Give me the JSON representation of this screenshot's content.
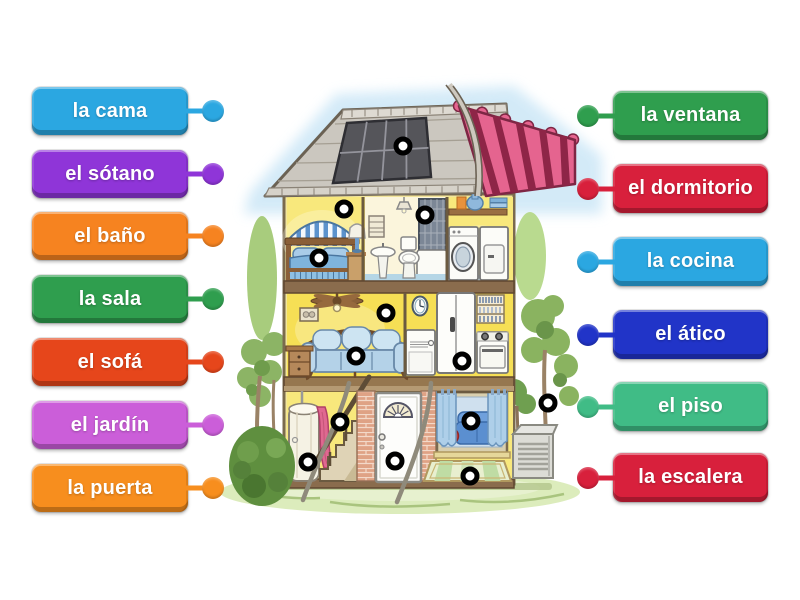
{
  "activity": {
    "type": "labelled-diagram",
    "background": "#ffffff",
    "marker_style": {
      "ring": "#000000",
      "center": "#ffffff"
    },
    "left_labels": [
      {
        "text": "la cama",
        "color": "#2BA7E1"
      },
      {
        "text": "el sótano",
        "color": "#8F35D8"
      },
      {
        "text": "el baño",
        "color": "#F68320"
      },
      {
        "text": "la sala",
        "color": "#2F9E4E"
      },
      {
        "text": "el sofá",
        "color": "#E6461B"
      },
      {
        "text": "el jardín",
        "color": "#CB5ED9"
      },
      {
        "text": "la puerta",
        "color": "#F78E1E"
      }
    ],
    "right_labels": [
      {
        "text": "la ventana",
        "color": "#2F9E4E"
      },
      {
        "text": "el dormitorio",
        "color": "#D8203C"
      },
      {
        "text": "la cocina",
        "color": "#2BA7E1"
      },
      {
        "text": "el ático",
        "color": "#2134C8"
      },
      {
        "text": "el piso",
        "color": "#40BC86"
      },
      {
        "text": "la escalera",
        "color": "#D8203C"
      }
    ],
    "markers": [
      {
        "name": "attic-roof",
        "x": 403,
        "y": 146
      },
      {
        "name": "bedroom",
        "x": 344,
        "y": 209
      },
      {
        "name": "bathroom",
        "x": 425,
        "y": 215
      },
      {
        "name": "bed",
        "x": 319,
        "y": 258
      },
      {
        "name": "living-room",
        "x": 386,
        "y": 313
      },
      {
        "name": "sofa",
        "x": 356,
        "y": 356
      },
      {
        "name": "kitchen",
        "x": 462,
        "y": 361
      },
      {
        "name": "stairs",
        "x": 340,
        "y": 422
      },
      {
        "name": "window",
        "x": 471,
        "y": 421
      },
      {
        "name": "garden",
        "x": 548,
        "y": 403
      },
      {
        "name": "water-heater",
        "x": 308,
        "y": 462
      },
      {
        "name": "door",
        "x": 395,
        "y": 461
      },
      {
        "name": "rug-floor",
        "x": 470,
        "y": 476
      }
    ]
  }
}
